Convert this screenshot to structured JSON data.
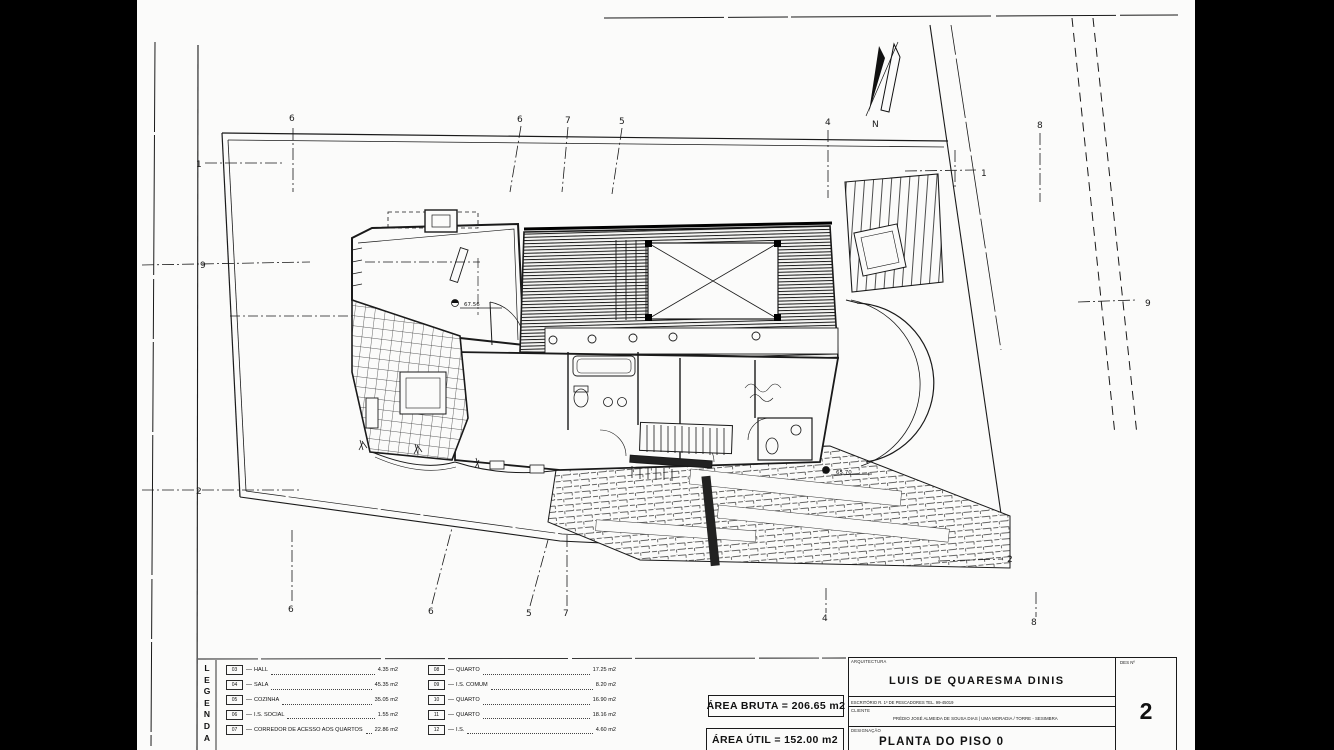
{
  "drawing": {
    "sheet_bg": "#fbfbfa",
    "ink": "#1a1a1a",
    "north_label": "N"
  },
  "plan": {
    "axis_markers": [
      {
        "label": "6",
        "x": 289,
        "y": 121
      },
      {
        "label": "6",
        "x": 517,
        "y": 122
      },
      {
        "label": "7",
        "x": 565,
        "y": 123
      },
      {
        "label": "5",
        "x": 619,
        "y": 124
      },
      {
        "label": "4",
        "x": 825,
        "y": 125
      },
      {
        "label": "8",
        "x": 1037,
        "y": 128
      },
      {
        "label": "1",
        "x": 196,
        "y": 167
      },
      {
        "label": "9",
        "x": 200,
        "y": 268
      },
      {
        "label": "2",
        "x": 196,
        "y": 494
      },
      {
        "label": "1",
        "x": 981,
        "y": 176
      },
      {
        "label": "9",
        "x": 1145,
        "y": 306
      },
      {
        "label": "2",
        "x": 1007,
        "y": 562
      },
      {
        "label": "6",
        "x": 288,
        "y": 612
      },
      {
        "label": "6",
        "x": 428,
        "y": 614
      },
      {
        "label": "5",
        "x": 526,
        "y": 616
      },
      {
        "label": "7",
        "x": 563,
        "y": 616
      },
      {
        "label": "4",
        "x": 822,
        "y": 621
      },
      {
        "label": "8",
        "x": 1031,
        "y": 625
      },
      {
        "label": "N",
        "x": 872,
        "y": 127
      }
    ],
    "spot_elevations": [
      {
        "value": "67.56",
        "x": 464,
        "y": 306
      },
      {
        "value": "65.70",
        "x": 836,
        "y": 474
      }
    ]
  },
  "legend": {
    "title_letters": [
      "L",
      "E",
      "G",
      "E",
      "N",
      "D",
      "A"
    ],
    "columns": [
      [
        {
          "code": "03",
          "label": "HALL",
          "value": "4.35 m2"
        },
        {
          "code": "04",
          "label": "SALA",
          "value": "45.35 m2"
        },
        {
          "code": "05",
          "label": "COZINHA",
          "value": "35.05 m2"
        },
        {
          "code": "06",
          "label": "I.S. SOCIAL",
          "value": "1.55 m2"
        },
        {
          "code": "07",
          "label": "CORREDOR DE ACESSO AOS QUARTOS",
          "value": "22.86 m2"
        }
      ],
      [
        {
          "code": "08",
          "label": "QUARTO",
          "value": "17.25 m2"
        },
        {
          "code": "09",
          "label": "I.S. COMUM",
          "value": "8.20 m2"
        },
        {
          "code": "10",
          "label": "QUARTO",
          "value": "16.90 m2"
        },
        {
          "code": "11",
          "label": "QUARTO",
          "value": "18.16 m2"
        },
        {
          "code": "12",
          "label": "I.S.",
          "value": "4.60 m2"
        }
      ]
    ]
  },
  "areas": {
    "bruta": "ÁREA BRUTA = 206.65 m2",
    "util": "ÁREA ÚTIL = 152.00 m2"
  },
  "title_block": {
    "architect_label": "ARQUITECTURA",
    "architect": "LUIS DE QUARESMA DINIS",
    "office_line": "ESCRITÓRIO  R. 1º DE  PESCADORES   TEL. 99-45019",
    "client_label": "CLIENTE",
    "client": "PRÉDIO JOSÉ ALMEIDA DE SOUSA DIAS | UMA MORADIA / TORRE - SESIMBRA",
    "designation_label": "DESIGNAÇÃO",
    "designation": "PLANTA DO PISO 0",
    "number_label": "DES Nº",
    "number": "2"
  }
}
